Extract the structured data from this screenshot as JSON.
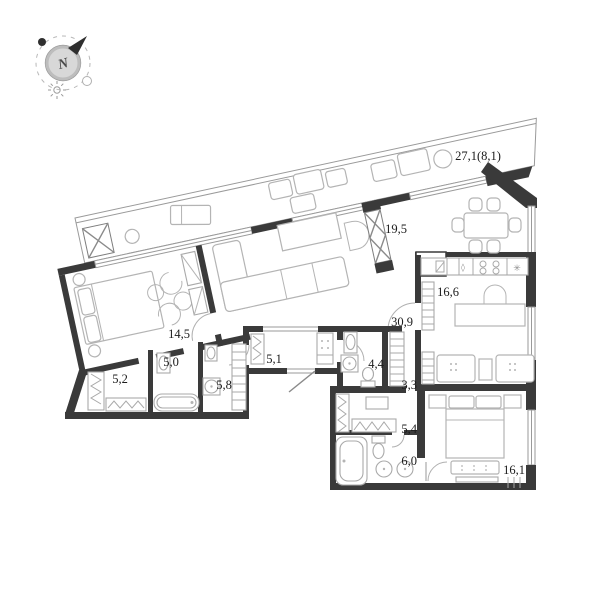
{
  "title": "apartment-floor-plan",
  "compass": {
    "letter": "N"
  },
  "rooms": {
    "terrace": {
      "label": "27,1(8,1)",
      "name": "terrace"
    },
    "living": {
      "label": "19,5",
      "name": "living-room"
    },
    "kitchen": {
      "label": "16,6",
      "name": "kitchen-lounge"
    },
    "corridor_main": {
      "label": "30,9",
      "name": "main-corridor"
    },
    "bedroom_master": {
      "label": "14,5",
      "name": "master-bedroom"
    },
    "hallway": {
      "label": "5,1",
      "name": "entrance-hall"
    },
    "bath_1": {
      "label": "5,0",
      "name": "bathroom-1"
    },
    "closet_1": {
      "label": "5,2",
      "name": "walk-in-closet"
    },
    "bath_2": {
      "label": "5,8",
      "name": "bathroom-2"
    },
    "bath_3": {
      "label": "4,4",
      "name": "bathroom-3"
    },
    "corridor_2": {
      "label": "3,3",
      "name": "small-corridor"
    },
    "wardrobe": {
      "label": "5,4",
      "name": "wardrobe-room"
    },
    "bath_4": {
      "label": "6,0",
      "name": "bathroom-4"
    },
    "bedroom_2": {
      "label": "16,1",
      "name": "bedroom-2"
    }
  },
  "kitchen_symbols": {
    "drop": "◊",
    "vent": "✳"
  },
  "colors": {
    "wall": "#3a3a3a",
    "thin_line": "#9a9a9a",
    "furniture_line": "#b4b4b4",
    "label_text": "#1c1c1c",
    "compass_fill": "#d8d8d8",
    "background": "#ffffff"
  }
}
